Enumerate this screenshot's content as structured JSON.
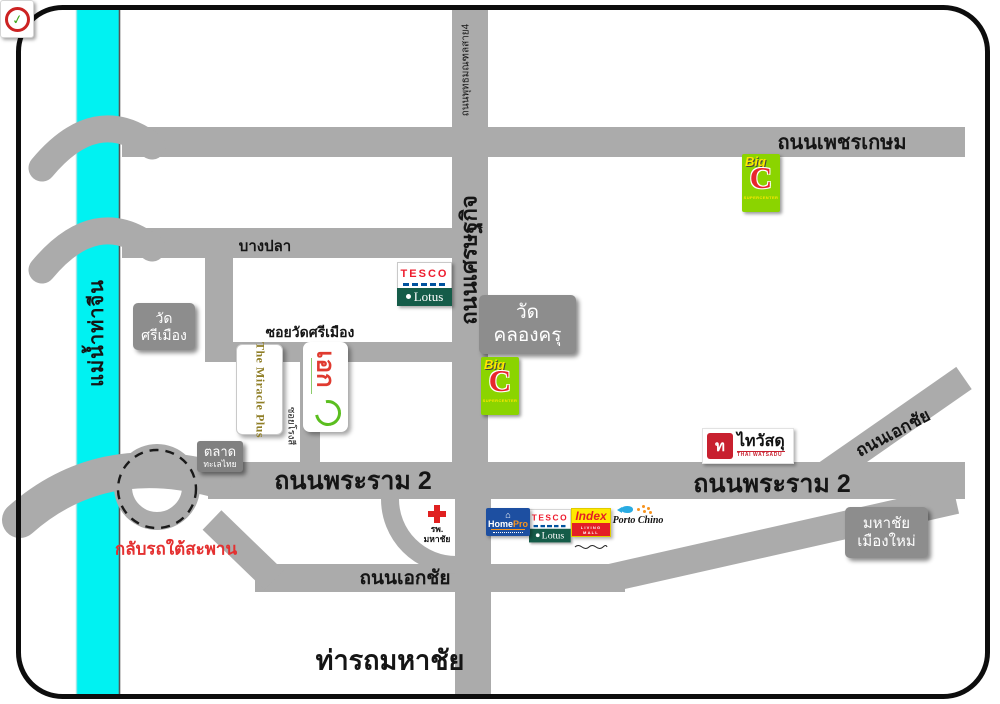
{
  "map": {
    "river": {
      "label": "แม่น้ำท่าจีน"
    },
    "roads": {
      "phetkasem": "ถนนเพชรเกษม",
      "phutthamonthon_sai4": "ถนนพุทธมณฑลสาย4",
      "setthakit": "ถนนเศรษฐกิจ",
      "bangpla": "บางปลา",
      "soi_wat_si_mueang": "ซอยวัดศรีเมือง",
      "soi_small": "ซอยโรงสี",
      "rama2": "ถนนพระราม 2",
      "ekachai": "ถนนเอกชัย"
    },
    "places": {
      "wat_si_mueang": {
        "line1": "วัด",
        "line2": "ศรีเมือง"
      },
      "wat_khlong_khru": {
        "line1": "วัด",
        "line2": "คลองครุ"
      },
      "mahachai_mueang_mai": {
        "line1": "มหาชัย",
        "line2": "เมืองใหม่"
      },
      "talat_talay_thai": {
        "line1": "ตลาด",
        "line2": "ทะเลไทย"
      },
      "tha_rot_mahachai": "ท่ารถมหาชัย",
      "u_turn_note": "กลับรถใต้สะพาน",
      "hospital": {
        "line1": "รพ.",
        "line2": "มหาชัย"
      }
    },
    "logos": {
      "tesco_lotus": {
        "tesco": "TESCO",
        "lotus": "Lotus"
      },
      "big_c": {
        "big": "Big",
        "c": "C",
        "sub": "SUPERCENTER"
      },
      "miracle_plus": {
        "name": "The Miracle Plus"
      },
      "ek": {
        "name": "เอก"
      },
      "thai_watsadu": {
        "symbol": "ท",
        "thai": "ไทวัสดุ",
        "eng": "THAI WATSADU"
      },
      "homepro": {
        "home": "Home",
        "pro": "Pro"
      },
      "index": {
        "name": "Index",
        "bar": "LIVING MALL"
      },
      "porto_chino": {
        "name": "Porto Chino"
      }
    },
    "colors": {
      "road": "#ABABAB",
      "river": "#00F2F2",
      "landmark_box": "#8D8D8D",
      "u_turn_text": "#E43030",
      "bigc_green": "#8BD400",
      "bigc_red": "#E8262D",
      "tesco_red": "#EE1C2E",
      "lotus_green": "#155C49",
      "homepro_blue": "#1D4FA1",
      "index_yellow": "#FFE800",
      "watsadu_red": "#C8202F"
    }
  }
}
